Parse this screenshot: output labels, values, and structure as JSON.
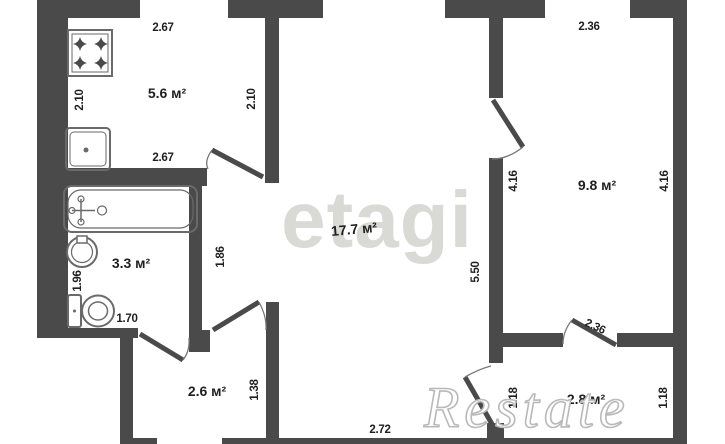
{
  "watermarks": {
    "center": "etagi",
    "corner": "Restate"
  },
  "rooms": {
    "kitchen": "5.6 м²",
    "bathroom": "3.3 м²",
    "living": "17.7 м²",
    "bedroom": "9.8 м²",
    "hallway": "2.6 м²",
    "balcony": "2.8 м²"
  },
  "dims": {
    "kitchen_top": "2.67",
    "kitchen_bottom": "2.67",
    "kitchen_left": "2.10",
    "kitchen_right": "2.10",
    "bedroom_top": "2.36",
    "bedroom_left": "4.16",
    "bedroom_right": "4.16",
    "living_right": "5.50",
    "passage_left": "1.86",
    "bath_left": "1.96",
    "bath_bottom": "1.70",
    "hall_right": "1.38",
    "balcony_door": "2.36",
    "balcony_left": "1.18",
    "balcony_right": "1.18",
    "living_bottom": "2.72"
  },
  "colors": {
    "wall": "#4a4a4a",
    "label": "#1f1f1f",
    "fixture": "#6a6a6a",
    "wm": "#d9d9d6",
    "wm2": "#b9b9b9"
  }
}
